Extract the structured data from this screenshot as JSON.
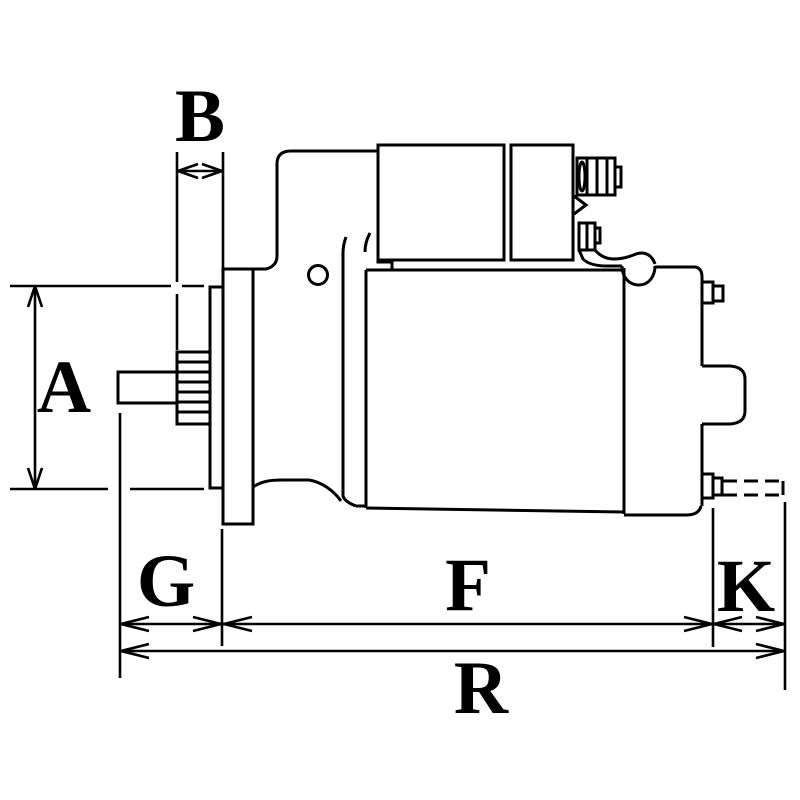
{
  "diagram": {
    "subject": "starter-motor-dimension-drawing",
    "background_color": "#ffffff",
    "line_color": "#000000",
    "dimension_labels": {
      "a": "A",
      "b": "B",
      "g": "G",
      "f": "F",
      "k": "K",
      "r": "R"
    }
  }
}
